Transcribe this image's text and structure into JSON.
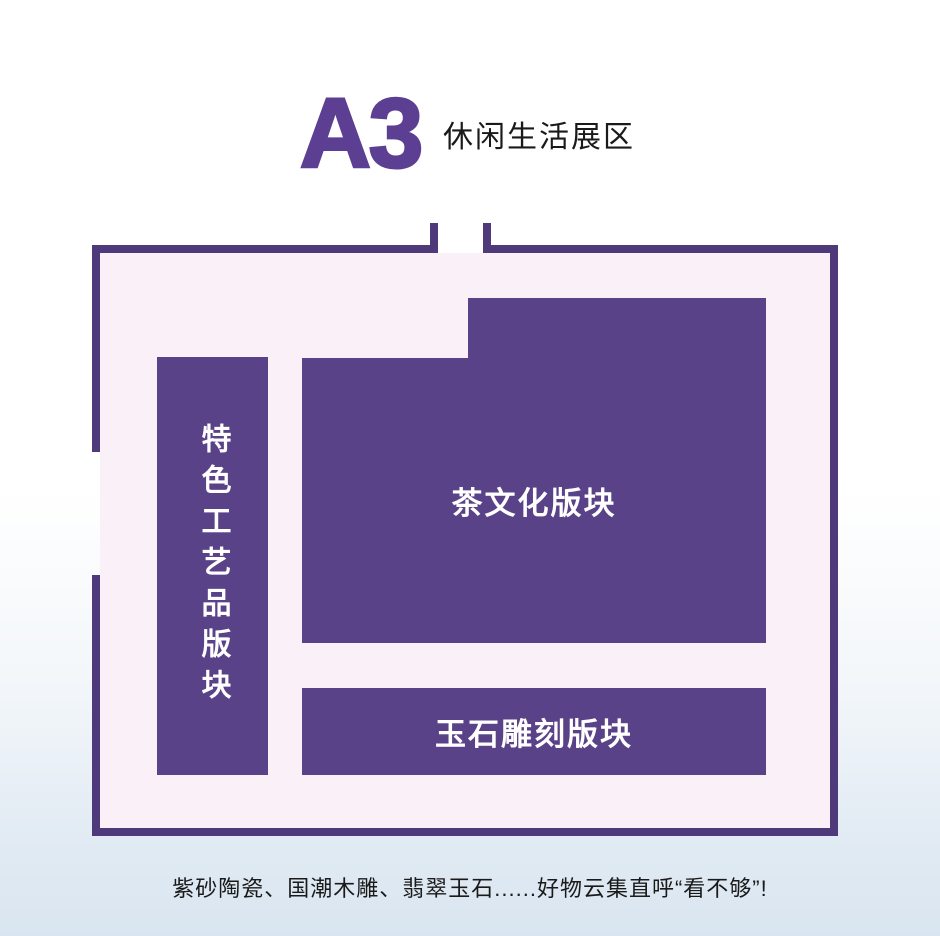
{
  "header": {
    "code": "A3",
    "name": "休闲生活展区"
  },
  "floor_plan": {
    "blocks": [
      {
        "id": "special-crafts",
        "label": "特色工艺品版块",
        "orientation": "vertical"
      },
      {
        "id": "tea-culture",
        "label": "茶文化版块",
        "orientation": "horizontal"
      },
      {
        "id": "jade-carving",
        "label": "玉石雕刻版块",
        "orientation": "horizontal"
      }
    ]
  },
  "caption": "紫砂陶瓷、国潮木雕、翡翠玉石......好物云集直呼“看不够”!",
  "colors": {
    "block_purple": "#594288",
    "wall_purple": "#4e3a7b",
    "room_fill": "#faf0f7",
    "title_purple": "#5c3f93",
    "text_dark": "#1a1a1a",
    "background_bottom": "#d9e5f0"
  }
}
